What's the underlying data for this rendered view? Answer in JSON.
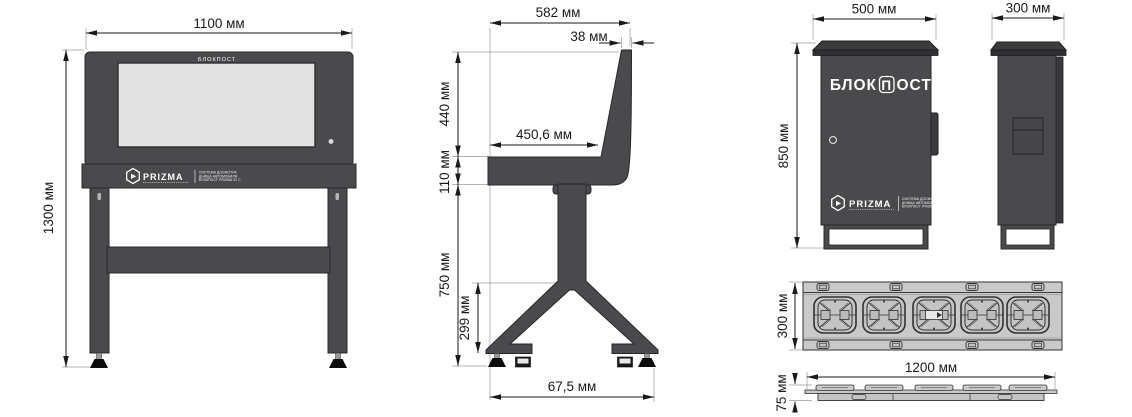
{
  "labels": {
    "console_front": {
      "width": "1100 мм",
      "height": "1300 мм",
      "bezel": "БЛОКПОСТ"
    },
    "console_side": {
      "depth": "582 мм",
      "top": "38 мм",
      "display": "440 мм",
      "shelf": "110 мм",
      "shelf_depth": "450,6 мм",
      "pedestal": "750 мм",
      "base": "299 мм",
      "feet": "67,5 мм"
    },
    "cabinet_front": {
      "width": "500 мм",
      "height": "850 мм",
      "brand_prefix": "БЛОК",
      "brand_letter": "П",
      "brand_suffix": "ОСТ"
    },
    "cabinet_side": {
      "depth": "300 мм"
    },
    "plate_top": {
      "width": "300 мм"
    },
    "plate_side": {
      "length": "1200 мм",
      "height": "75 мм"
    },
    "branding": {
      "logo": "PRIZMA",
      "tagline1": "СИСТЕМА ДОСМОТРА",
      "tagline2": "ДНИЩА АВТОМОБИЛЯ",
      "tagline3": "БЛОКПОСТ PRIZMA 02 С"
    }
  },
  "colors": {
    "body": "#4a4a4d",
    "screen": "#e2e2e2",
    "plate": "#c9c9c9",
    "line": "#1a1a1a"
  }
}
